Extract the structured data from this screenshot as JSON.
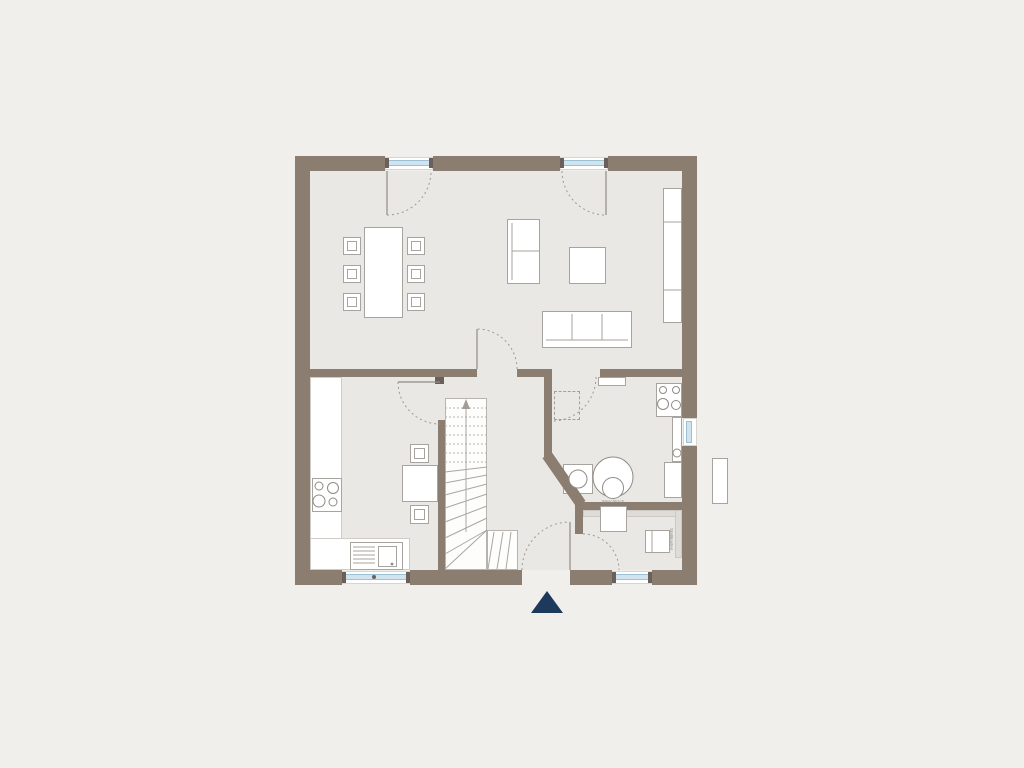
{
  "document": {
    "type": "architectural-floor-plan",
    "floor": "ground-floor"
  },
  "colors": {
    "background": "#f0efeb",
    "wall": "#8b7d70",
    "wall_dark": "#6b6059",
    "floor": "#eae8e4",
    "furniture_line": "#a7a39e",
    "window_glass": "#cfe4ee",
    "window_glass_border": "#9cc0d4",
    "entrance_marker_navy": "#1d3a5c",
    "vanity_counter": "#dfdcd7"
  },
  "labels": {
    "wc_sink": "Waschtisch",
    "wc_toilet": "Spülkasten"
  },
  "icons": {
    "entrance_marker": "filled-triangle-up",
    "stair_direction": "arrow-up"
  },
  "rooms": [
    "living-dining-room",
    "kitchen",
    "hall-with-stairs",
    "utility-room",
    "wc"
  ]
}
